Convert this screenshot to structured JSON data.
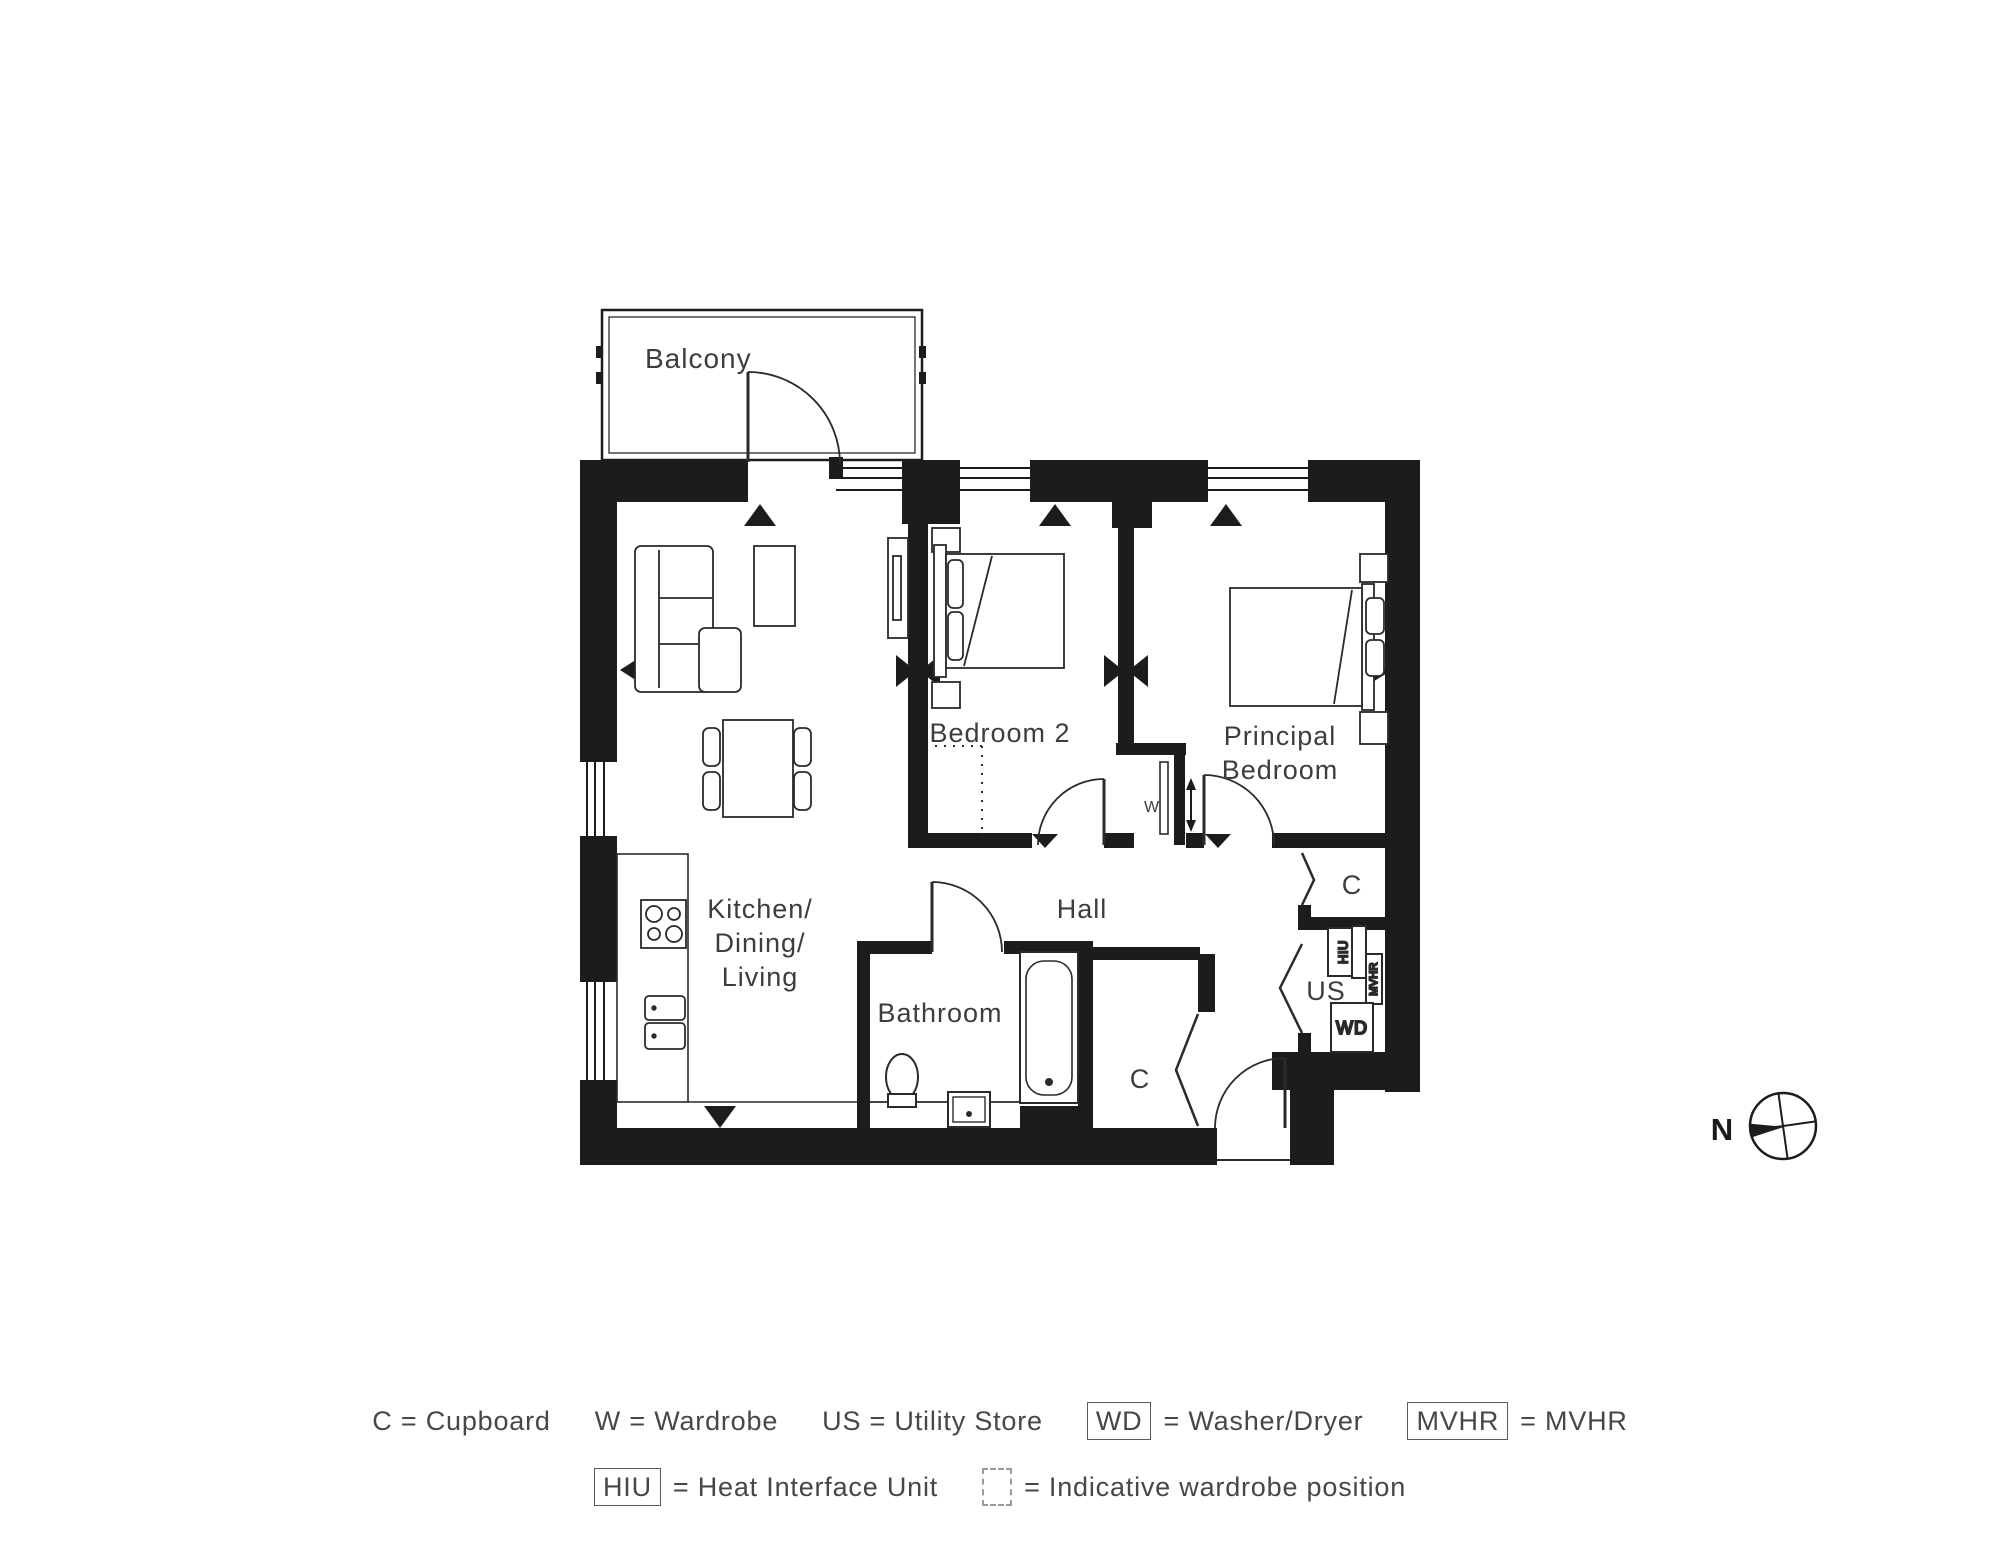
{
  "rooms": {
    "balcony": "Balcony",
    "kitchen_line1": "Kitchen/",
    "kitchen_line2": "Dining/",
    "kitchen_line3": "Living",
    "bedroom2": "Bedroom 2",
    "principal_line1": "Principal",
    "principal_line2": "Bedroom",
    "hall": "Hall",
    "bathroom": "Bathroom",
    "cupboard_top": "C",
    "cupboard_bottom": "C",
    "utility_store": "US"
  },
  "tags": {
    "wardrobe": "W",
    "hiu": "HIU",
    "mvhr": "MVHR",
    "wd": "WD"
  },
  "compass": {
    "north": "N"
  },
  "legend": {
    "row1": [
      {
        "symbol": "",
        "text": "C = Cupboard"
      },
      {
        "symbol": "",
        "text": "W = Wardrobe"
      },
      {
        "symbol": "",
        "text": "US = Utility Store"
      },
      {
        "symbol": "WD",
        "text": "= Washer/Dryer"
      },
      {
        "symbol": "MVHR",
        "text": "= MVHR"
      }
    ],
    "row2": [
      {
        "symbol": "HIU",
        "text": "= Heat Interface Unit"
      },
      {
        "symbol": "",
        "text": "= Indicative wardrobe position"
      }
    ]
  },
  "colors": {
    "wall": "#1c1c1c",
    "line": "#2a2a2a",
    "text": "#3d3d3d"
  }
}
